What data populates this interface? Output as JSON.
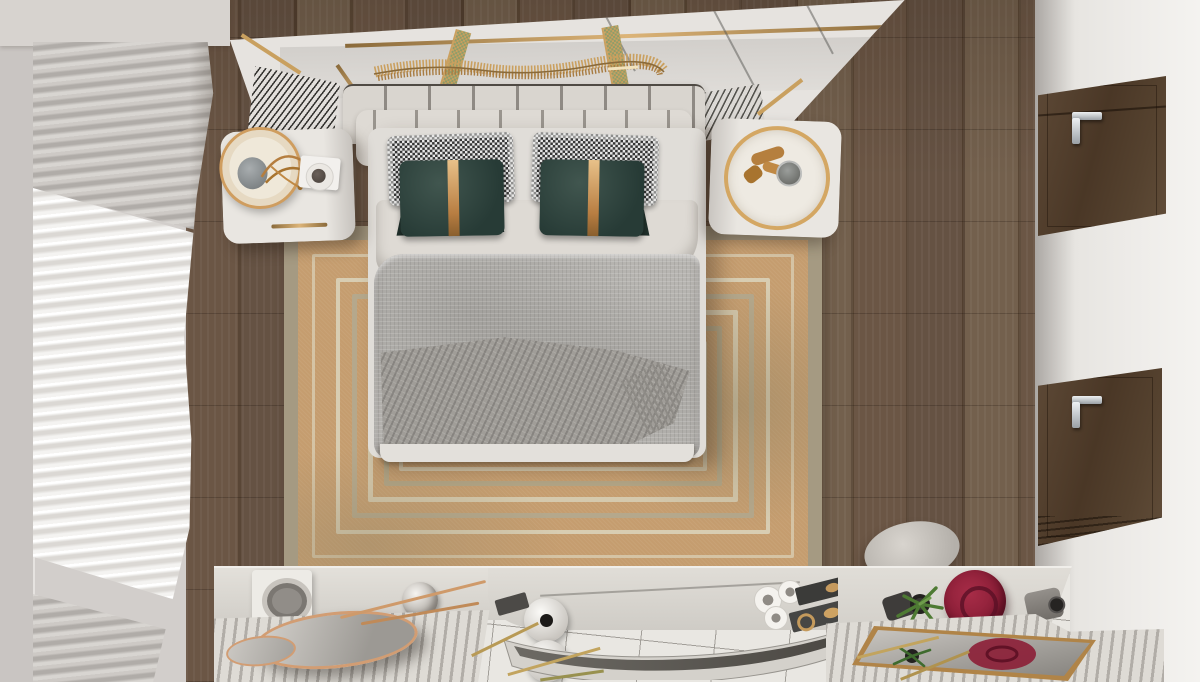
{
  "scene": {
    "description": "Top-down 3D render of a modern luxury bedroom: channel-tufted bed with houndstooth and teal velvet pillows, layered concentric-stripe rug, round white nightstands, pleated curtains along the window wall, dark walnut plank floor, walnut wardrobe doors with chrome handles, and dresser consoles with decor (red velvet vase, brass mirror trays, curved display bench).",
    "view": "top-down",
    "room": "bedroom",
    "palette": {
      "wall": "#d9d5d1",
      "wall_left": "#c9c5c2",
      "window_wall": "#d2cecb",
      "wood_floor": "#5e4b3a",
      "tile_floor": "#e9e7e2",
      "ceiling_panel": "#e6e3df",
      "headboard": "#d9d5cf",
      "mattress": "#e0ddd8",
      "sheet": "#dedad4",
      "duvet": "#b7b5b1",
      "throw": "#a09d98",
      "pillow_houndstooth_light": "#e9e9e9",
      "pillow_houndstooth_dark": "#343434",
      "pillow_velvet_teal": "#2c403a",
      "gold_accent": "#c99a5f",
      "rug_border_olive": "#a59a82",
      "rug_field_tan": "#c59d6f",
      "rug_stripe_cream": "#d5c9ad",
      "nightstand": "#e8e5e0",
      "curtain_sheer": "#f2f1ee",
      "curtain_gray": "#bdb9b5",
      "wardrobe_walnut": "#523f2d",
      "handle_chrome": "#cfd3d6",
      "console": "#d9d6d0",
      "ribbed_surface": "#dcd9d3",
      "copper_mirror_rim": "#d29d73",
      "red_velvet_vase": "#8c1f38",
      "plant_green": "#4e7a33",
      "pouf": "#c9c5bf"
    },
    "objects": [
      {
        "id": "bed",
        "label": "Double bed with white sheet fold and gray quilted duvet"
      },
      {
        "id": "headboard",
        "label": "Cream channel-tufted headboard"
      },
      {
        "id": "pillow-houndstooth-left",
        "label": "Houndstooth pillow (left)"
      },
      {
        "id": "pillow-houndstooth-right",
        "label": "Houndstooth pillow (right)"
      },
      {
        "id": "pillow-teal-left",
        "label": "Teal velvet pillow with brass band (left)"
      },
      {
        "id": "pillow-teal-right",
        "label": "Teal velvet pillow with brass band (right)"
      },
      {
        "id": "throw-blanket",
        "label": "Gray fringed throw blanket"
      },
      {
        "id": "rug",
        "label": "Tan area rug with concentric stripe border"
      },
      {
        "id": "nightstand-left",
        "label": "White rounded nightstand with drum lamp, book and coffee cup"
      },
      {
        "id": "nightstand-right",
        "label": "White rounded nightstand with brass tray and glass"
      },
      {
        "id": "ceiling-sculpture",
        "label": "Brass wave sculpture over mirrored headboard panel"
      },
      {
        "id": "vent-grilles",
        "label": "Slatted vent grilles beside headboard"
      },
      {
        "id": "curtains",
        "label": "Pleated sheer and gray curtains along window wall"
      },
      {
        "id": "wood-floor",
        "label": "Dark walnut plank floor"
      },
      {
        "id": "tile-floor",
        "label": "White tiled floor at foot of room"
      },
      {
        "id": "wardrobe-doors",
        "label": "Two walnut wardrobe doors with chrome lever handles"
      },
      {
        "id": "pouf",
        "label": "Round gray pouf"
      },
      {
        "id": "dresser-left",
        "label": "Ribbed-top dresser with copper-rim round mirrors, bowl box and marble sphere"
      },
      {
        "id": "display-bench",
        "label": "Curved display bench with white sphere vases, cups and black trays"
      },
      {
        "id": "console-right",
        "label": "Console with red velvet vase, succulent, bottle and gray cylinder vase"
      },
      {
        "id": "mirror-tray",
        "label": "Brass-framed mirror tray reflecting the red vase and plant"
      },
      {
        "id": "brass-sticks",
        "label": "Scattered brass sticks on tile floor"
      }
    ]
  }
}
